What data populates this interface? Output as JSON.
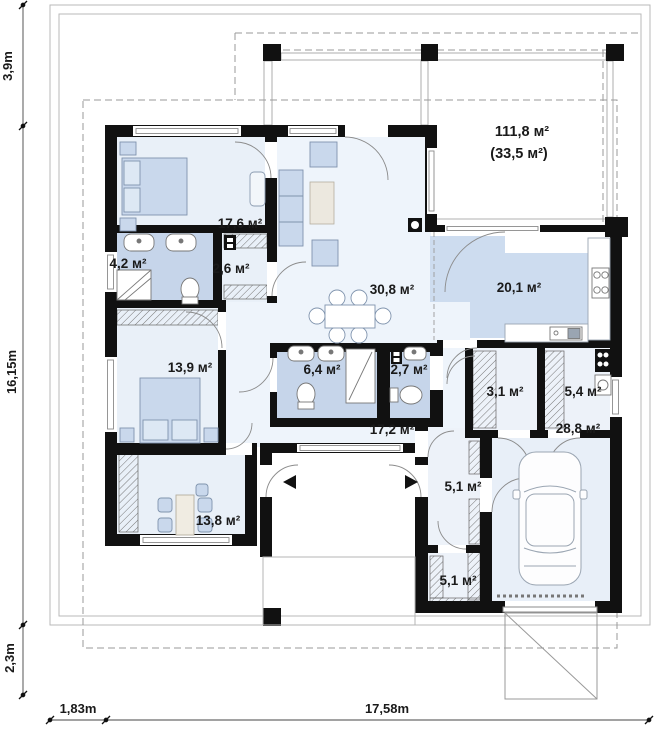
{
  "plan_title": "House floor plan",
  "rooms": [
    {
      "id": "bedroom-1",
      "area": "17,6 м²"
    },
    {
      "id": "bathroom-1",
      "area": "4,2 м²"
    },
    {
      "id": "wardrobe",
      "area": "2,6 м²"
    },
    {
      "id": "living-room",
      "area": "30,8 м²"
    },
    {
      "id": "kitchen",
      "area": "20,1 м²"
    },
    {
      "id": "bedroom-2",
      "area": "13,9 м²"
    },
    {
      "id": "bathroom-2",
      "area": "6,4 м²"
    },
    {
      "id": "wc",
      "area": "2,7 м²"
    },
    {
      "id": "pantry",
      "area": "3,1 м²"
    },
    {
      "id": "utility",
      "area": "5,4 м²"
    },
    {
      "id": "corridor",
      "area": "17,2 м²"
    },
    {
      "id": "garage",
      "area": "28,8 м²"
    },
    {
      "id": "hall",
      "area": "5,1 м²"
    },
    {
      "id": "office",
      "area": "13,8 м²"
    },
    {
      "id": "storage",
      "area": "5,1 м²"
    }
  ],
  "terrace": {
    "area": "111,8 м²",
    "area_secondary": "(33,5 м²)"
  },
  "dimensions": {
    "left_top": "3,9m",
    "left_middle": "16,15m",
    "left_bottom": "2,3m",
    "bottom_left": "1,83m",
    "bottom_right": "17,58m"
  },
  "colors": {
    "wall": "#111111",
    "room_fill": "#eaf1f9",
    "wet_room_fill": "#c6d5ea",
    "kitchen_fill": "#cddcef",
    "line": "#999999"
  }
}
